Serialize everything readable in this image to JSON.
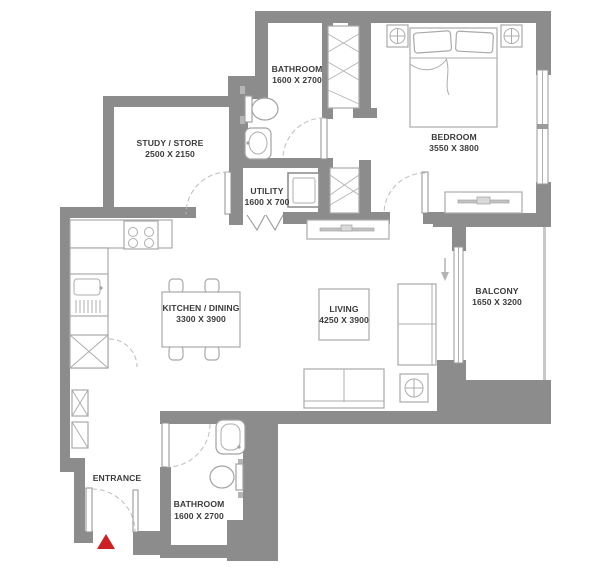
{
  "plan": {
    "type": "apartment-floor-plan",
    "rooms": {
      "study": {
        "label": "STUDY / STORE",
        "dims": "2500 X 2150"
      },
      "bathroom_top": {
        "label": "BATHROOM",
        "dims": "1600 X 2700"
      },
      "utility": {
        "label": "UTILITY",
        "dims": "1600 X 700"
      },
      "bedroom": {
        "label": "BEDROOM",
        "dims": "3550 X 3800"
      },
      "balcony": {
        "label": "BALCONY",
        "dims": "1650 X 3200"
      },
      "kitchen_dining": {
        "label": "KITCHEN / DINING",
        "dims": "3300 X 3900"
      },
      "living": {
        "label": "LIVING",
        "dims": "4250 X 3900"
      },
      "bathroom_bottom": {
        "label": "BATHROOM",
        "dims": "1600 X 2700"
      },
      "entrance": {
        "label": "ENTRANCE"
      }
    },
    "icons": {
      "entrance_marker": "red-up-triangle",
      "balcony_access": "down-arrow",
      "ceiling_lamp": "circle-cross"
    },
    "colors": {
      "wall": "#8c8c8c",
      "furniture_line": "#a9a9a9",
      "text": "#3b3b3b",
      "entrance_marker": "#cc2024",
      "background": "#ffffff"
    }
  }
}
